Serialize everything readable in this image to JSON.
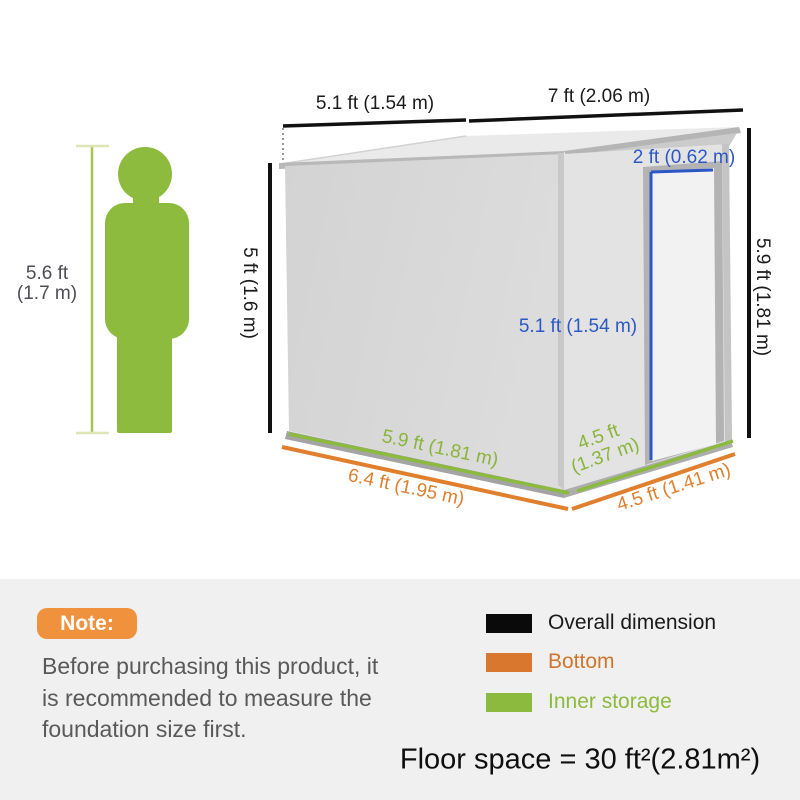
{
  "shed_diagram": {
    "person": {
      "height_label": "5.6 ft\n(1.7 m)"
    },
    "labels": {
      "roof_left_width": "5.1 ft (1.54 m)",
      "roof_right_width": "7 ft (2.06 m)",
      "wall_left_height": "5 ft (1.6 m)",
      "wall_right_height": "5.9 ft (1.81 m)",
      "door_width": "2 ft (0.62 m)",
      "door_height": "5.1 ft (1.54 m)",
      "inner_front_width": "5.9 ft (1.81 m)",
      "inner_side_depth": "4.5 ft\n(1.37 m)",
      "bottom_front_width": "6.4 ft (1.95 m)",
      "bottom_side_depth": "4.5 ft (1.41 m)"
    },
    "colors": {
      "overall_dimension_lines": "#111111",
      "bottom_lines": "#e0802f",
      "inner_storage_lines": "#8cba3e",
      "door_accent": "#2c58c6",
      "person_figure": "#8dbb3e"
    }
  },
  "note": {
    "badge": "Note:",
    "lines": [
      "Before purchasing this product, it",
      "is recommended to measure the",
      "foundation size first."
    ]
  },
  "legend": {
    "items": [
      {
        "label": "Overall dimension",
        "color": "#0a0a0a"
      },
      {
        "label": "Bottom",
        "color": "#d9772e"
      },
      {
        "label": "Inner storage",
        "color": "#8cba3e"
      }
    ]
  },
  "floor_space": "Floor space = 30 ft²(2.81m²)"
}
